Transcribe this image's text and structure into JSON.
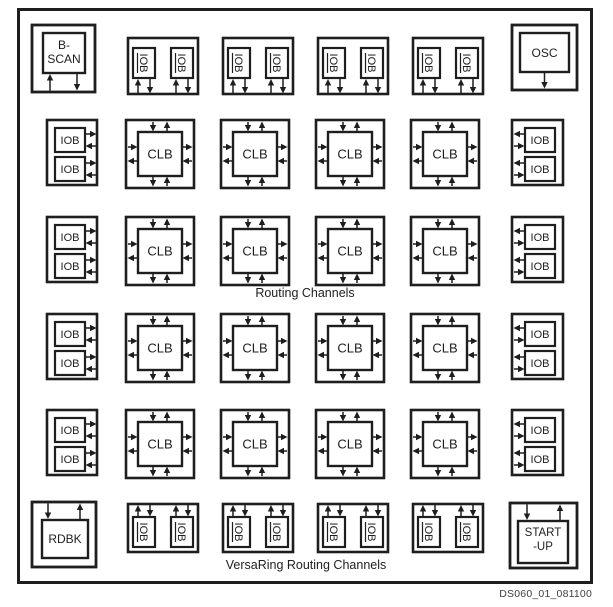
{
  "diagram": {
    "colors": {
      "line": "#1e1e1e",
      "background": "#ffffff",
      "footer_text": "#3f3f3f"
    },
    "top_row": {
      "bscan": {
        "lines": [
          "B-",
          "SCAN"
        ]
      },
      "iob_groups": [
        {
          "labels": [
            "IOB",
            "IOB"
          ]
        },
        {
          "labels": [
            "IOB",
            "IOB"
          ]
        },
        {
          "labels": [
            "IOB",
            "IOB"
          ]
        },
        {
          "labels": [
            "IOB",
            "IOB"
          ]
        }
      ],
      "osc": {
        "label": "OSC"
      }
    },
    "core_rows": [
      {
        "left_iob": {
          "labels": [
            "IOB",
            "IOB"
          ]
        },
        "clbs": [
          {
            "label": "CLB"
          },
          {
            "label": "CLB"
          },
          {
            "label": "CLB"
          },
          {
            "label": "CLB"
          }
        ],
        "right_iob": {
          "labels": [
            "IOB",
            "IOB"
          ]
        }
      },
      {
        "left_iob": {
          "labels": [
            "IOB",
            "IOB"
          ]
        },
        "clbs": [
          {
            "label": "CLB"
          },
          {
            "label": "CLB"
          },
          {
            "label": "CLB"
          },
          {
            "label": "CLB"
          }
        ],
        "right_iob": {
          "labels": [
            "IOB",
            "IOB"
          ]
        }
      },
      {
        "left_iob": {
          "labels": [
            "IOB",
            "IOB"
          ]
        },
        "clbs": [
          {
            "label": "CLB"
          },
          {
            "label": "CLB"
          },
          {
            "label": "CLB"
          },
          {
            "label": "CLB"
          }
        ],
        "right_iob": {
          "labels": [
            "IOB",
            "IOB"
          ]
        }
      },
      {
        "left_iob": {
          "labels": [
            "IOB",
            "IOB"
          ]
        },
        "clbs": [
          {
            "label": "CLB"
          },
          {
            "label": "CLB"
          },
          {
            "label": "CLB"
          },
          {
            "label": "CLB"
          }
        ],
        "right_iob": {
          "labels": [
            "IOB",
            "IOB"
          ]
        }
      }
    ],
    "bottom_row": {
      "rdbk": {
        "label": "RDBK"
      },
      "iob_groups": [
        {
          "labels": [
            "IOB",
            "IOB"
          ]
        },
        {
          "labels": [
            "IOB",
            "IOB"
          ]
        },
        {
          "labels": [
            "IOB",
            "IOB"
          ]
        },
        {
          "labels": [
            "IOB",
            "IOB"
          ]
        }
      ],
      "startup": {
        "lines": [
          "START",
          "-UP"
        ]
      }
    },
    "annotations": {
      "routing_channels": "Routing Channels",
      "versaring": "VersaRing Routing Channels",
      "figure_number": "DS060_01_081100"
    }
  }
}
